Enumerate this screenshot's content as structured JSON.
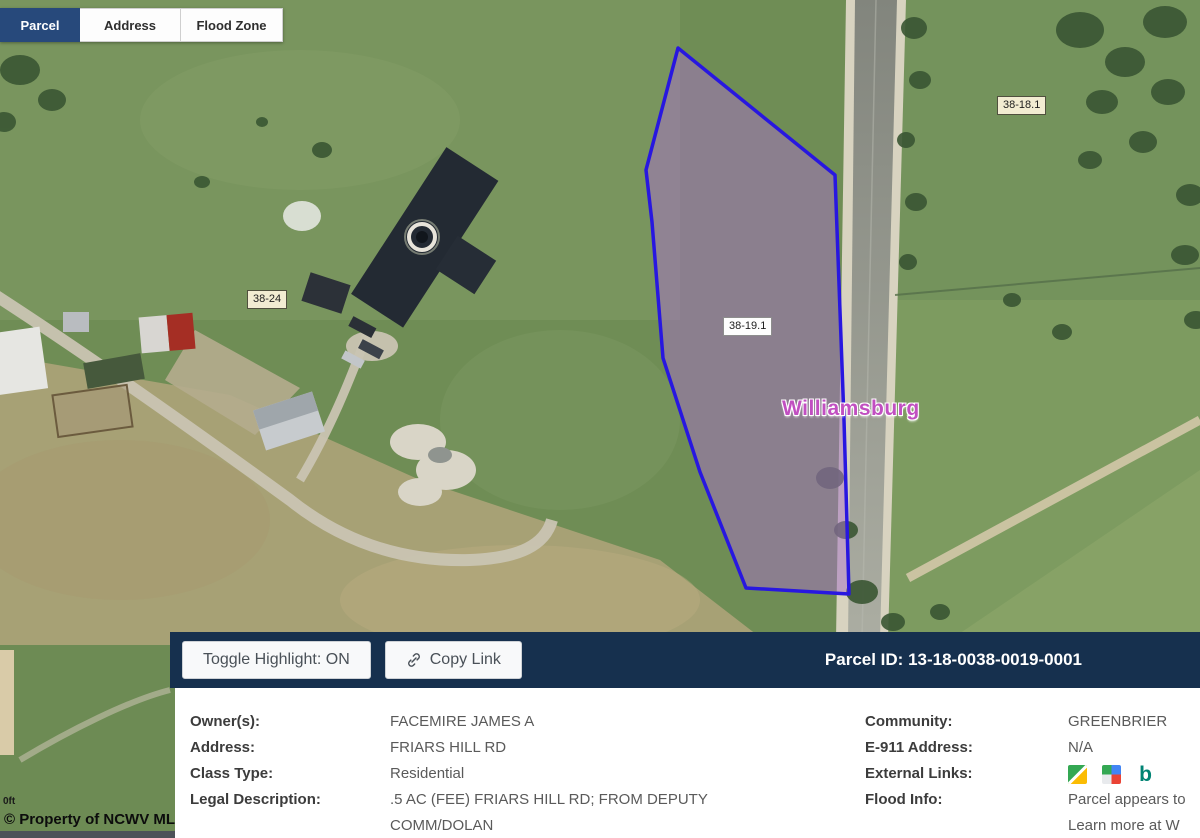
{
  "tabs": {
    "parcel": "Parcel",
    "address": "Address",
    "flood_zone": "Flood Zone"
  },
  "map_labels": {
    "parcel_selected": "38-19.1",
    "parcel_west": "38-24",
    "parcel_northeast": "38-18.1",
    "place_name": "Williamsburg",
    "scale": "0ft",
    "copyright": "© Property of NCWV MLS"
  },
  "toolbar": {
    "toggle_highlight": "Toggle Highlight: ON",
    "copy_link": "Copy Link",
    "parcel_id": "Parcel ID: 13-18-0038-0019-0001"
  },
  "details": {
    "left": [
      {
        "label": "Owner(s):",
        "value": "FACEMIRE JAMES A"
      },
      {
        "label": "Address:",
        "value": "FRIARS HILL RD"
      },
      {
        "label": "Class Type:",
        "value": "Residential"
      },
      {
        "label": "Legal Description:",
        "value": ".5 AC (FEE) FRIARS HILL RD; FROM DEPUTY COMM/DOLAN"
      }
    ],
    "right": [
      {
        "label": "Community:",
        "value": "GREENBRIER"
      },
      {
        "label": "E-911 Address:",
        "value": "N/A"
      },
      {
        "label": "External Links:"
      },
      {
        "label": "Flood Info:"
      }
    ],
    "flood_info": {
      "line1": "Parcel appears to",
      "line2": "Learn more at W"
    },
    "external_links": {
      "icons": [
        "google-maps-directions",
        "google-maps",
        "bing-maps"
      ],
      "bing_glyph": "b"
    }
  },
  "colors": {
    "toolbar_navy": "#16304e",
    "active_tab_blue": "#27497b",
    "parcel_outline": "#2817e0",
    "parcel_fill": "rgba(165,115,195,0.52)",
    "place_label": "#c14fc1"
  }
}
